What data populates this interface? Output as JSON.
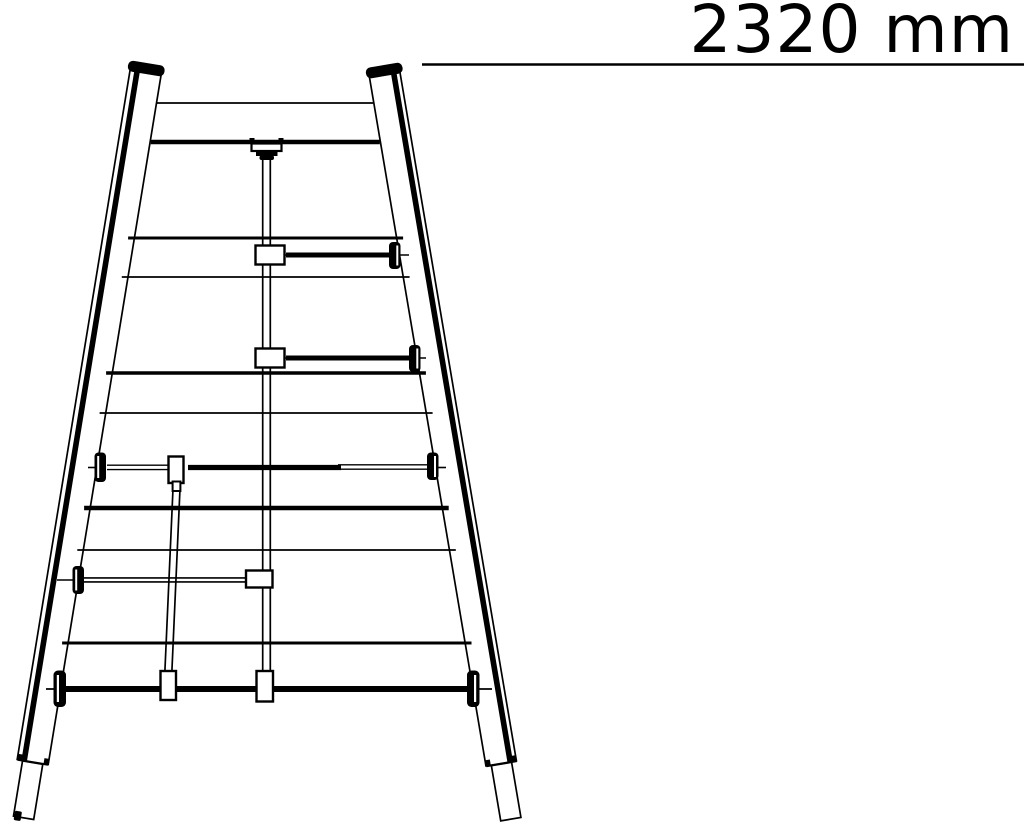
{
  "dimension": {
    "label": "2320 mm",
    "value_mm": 2320
  },
  "colors": {
    "line": "#000000",
    "background": "#ffffff"
  }
}
